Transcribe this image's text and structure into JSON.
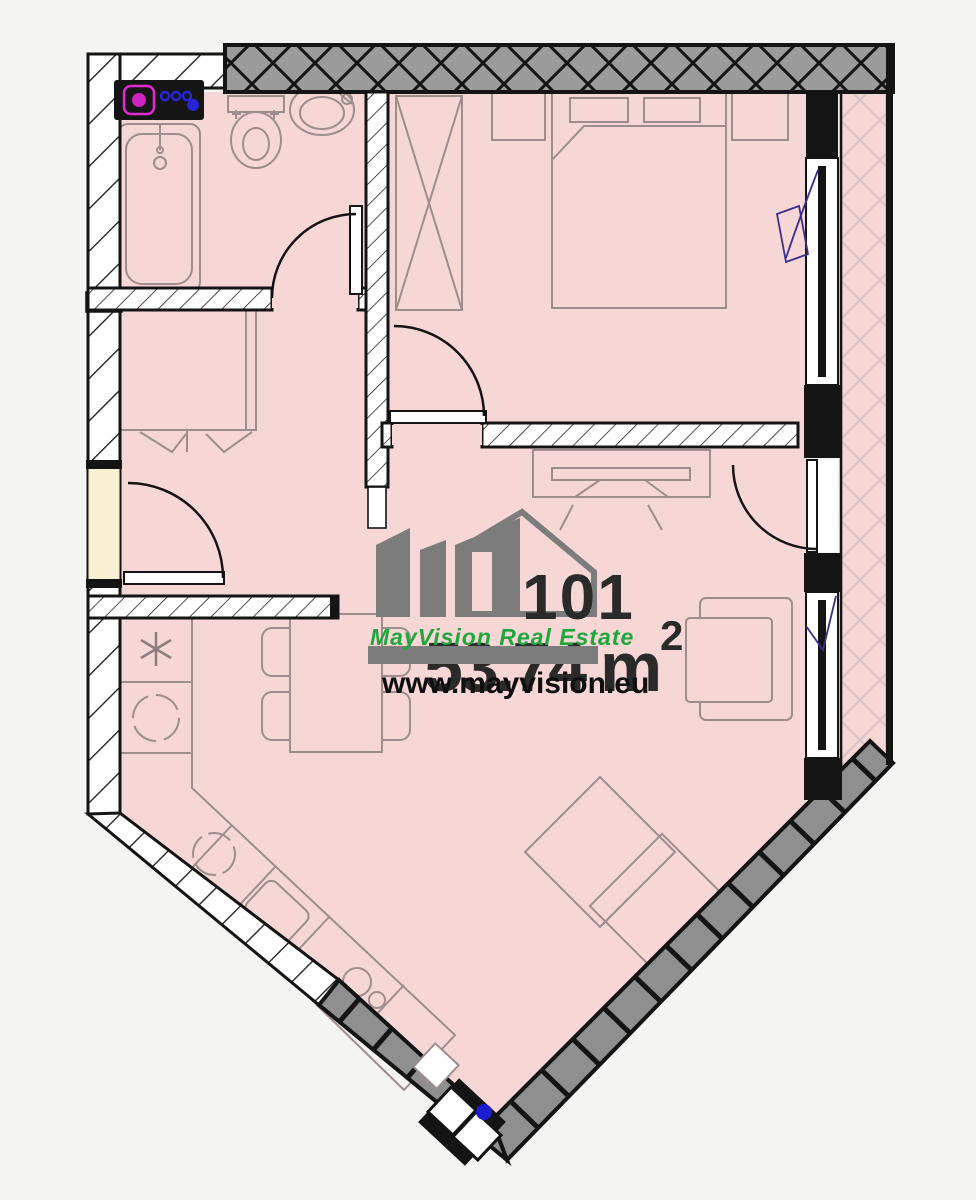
{
  "watermark": {
    "unit_number": "101",
    "area_value": "53.74",
    "area_unit": "m",
    "area_sup": "2",
    "brand": "MayVision Real Estate",
    "website": "www.mayvision.eu",
    "brand_color": "#1fa63c",
    "logo_color": "#7c7c7c",
    "number_color": "#2a2a2a",
    "website_color": "#0f0f0f"
  },
  "palette": {
    "floor": "#f7d6d6",
    "walls": "#141414",
    "exterior_wall_gray": "#9b9b9b",
    "balcony_lattice": "#dcc2c6",
    "furniture_line": "#9d8d8d",
    "accent_blue": "#2424d6",
    "accent_magenta": "#d928c8",
    "door_opening_fill": "#faf0d4",
    "background": "#f4f4f2"
  },
  "fixtures": [
    "washing-machine",
    "bathtub",
    "toilet",
    "wash-basin",
    "bathroom-door",
    "hall-closet",
    "entrance-door",
    "wardrobe",
    "nightstand-left",
    "double-bed",
    "nightstand-right",
    "bedroom-door",
    "balcony-door-bedroom",
    "balcony",
    "bedroom-window",
    "tv-stand",
    "balcony-door-living",
    "living-window",
    "armchair",
    "rug",
    "dining-table",
    "dining-chairs",
    "fridge-freezer",
    "under-counter-appliance",
    "kitchen-counter",
    "counter-appliance",
    "kitchen-sink",
    "cooktop",
    "corner-windows"
  ],
  "icons": {
    "freezer-icon": "❋",
    "burner-icon": "◯",
    "drum-icon": "◯"
  }
}
